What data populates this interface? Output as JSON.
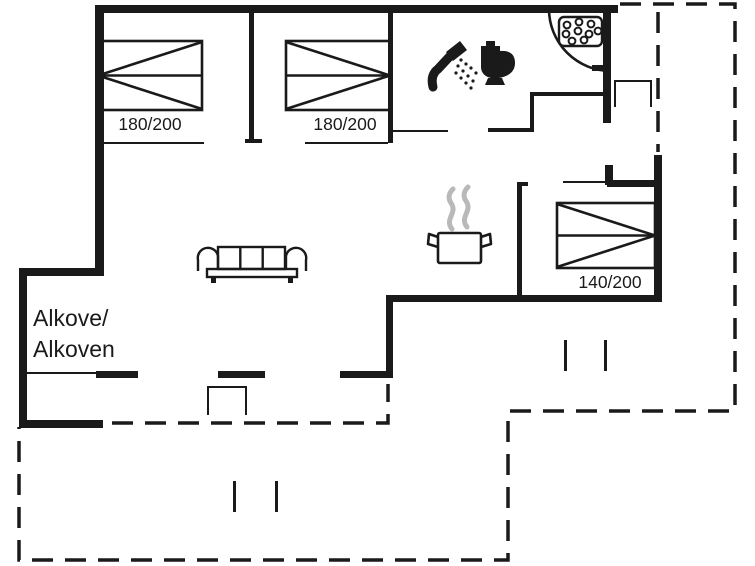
{
  "floorplan": {
    "type": "holiday-house-floor-plan",
    "beds": [
      {
        "label": "180/200"
      },
      {
        "label": "180/200"
      },
      {
        "label": "140/200"
      }
    ],
    "alcove": {
      "line1": "Alkove/",
      "line2": "Alkoven"
    },
    "icons": {
      "shower": "shower-head-icon",
      "toilet": "toilet-icon",
      "shower_tray": "shower-tray-dots-icon",
      "cooking_pot": "cooking-pot-icon",
      "steam": "steam-icon",
      "sofa": "sofa-icon",
      "beds": "double-bed-icon"
    },
    "colors": {
      "line": "#1a1a1a",
      "steam": "#b9b9b9",
      "background": "#ffffff"
    }
  }
}
